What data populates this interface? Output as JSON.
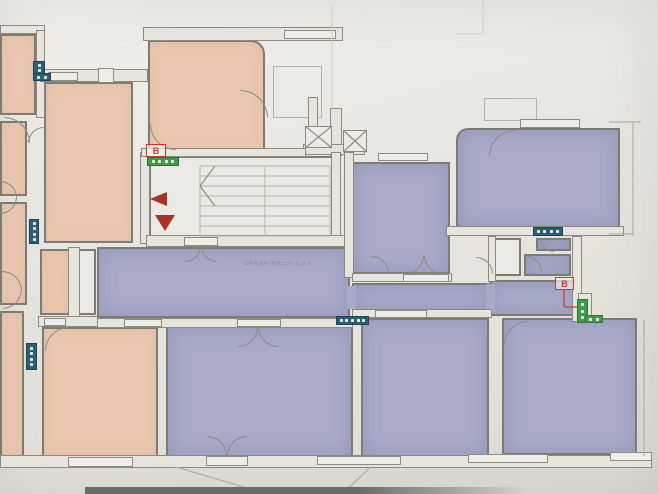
{
  "document": {
    "kind": "scanned-floor-plan-photo",
    "canvas": {
      "w": 658,
      "h": 494
    }
  },
  "corridor": {
    "label": "GRANATRVESF d o 6"
  },
  "palette": {
    "pink": "#eac8b0",
    "purple": "#a8aac8",
    "white_room": "#eae9e3",
    "wall_fill": "#e6e4dd",
    "wall_edge": "#8a8a81",
    "teal_marker": "#2b5f73",
    "green_marker": "#3f9c4a",
    "red_marker": "#c23b30",
    "paper": "#e8e6e1",
    "stair_line": "#b4b3ab",
    "faint_line": "#cfcdc6"
  },
  "rooms": [
    {
      "name": "room-top-left-partial",
      "fill": "pink",
      "x": 0,
      "y": 34,
      "w": 36,
      "h": 81
    },
    {
      "name": "room-left-2",
      "fill": "pink",
      "x": 0,
      "y": 121,
      "w": 27,
      "h": 75
    },
    {
      "name": "room-left-3",
      "fill": "pink",
      "x": 0,
      "y": 202,
      "w": 27,
      "h": 103
    },
    {
      "name": "room-left-4",
      "fill": "pink",
      "x": 0,
      "y": 311,
      "w": 24,
      "h": 147
    },
    {
      "name": "room-main-upper-pink",
      "fill": "pink",
      "x": 44,
      "y": 82,
      "w": 89,
      "h": 161
    },
    {
      "name": "room-left-lower-pink",
      "fill": "pink",
      "x": 40,
      "y": 249,
      "w": 30,
      "h": 66
    },
    {
      "name": "shaft-left",
      "fill": "white",
      "x": 78,
      "y": 249,
      "w": 18,
      "h": 66
    },
    {
      "name": "room-top-middle-pink",
      "fill": "pink",
      "x": 148,
      "y": 40,
      "w": 117,
      "h": 115,
      "rad": "0 14px 0 0"
    },
    {
      "name": "room-bottom-pink",
      "fill": "pink",
      "x": 42,
      "y": 327,
      "w": 116,
      "h": 130
    },
    {
      "name": "stairwell",
      "fill": "white",
      "x": 149,
      "y": 156,
      "w": 192,
      "h": 87
    },
    {
      "name": "corridor-main",
      "fill": "purple",
      "x": 97,
      "y": 247,
      "w": 253,
      "h": 71
    },
    {
      "name": "corridor-arm",
      "fill": "purple",
      "x": 352,
      "y": 283,
      "w": 140,
      "h": 28
    },
    {
      "name": "corridor-right-end",
      "fill": "purple",
      "x": 490,
      "y": 280,
      "w": 88,
      "h": 36
    },
    {
      "name": "room-middle-purple",
      "fill": "purple",
      "x": 352,
      "y": 162,
      "w": 98,
      "h": 112
    },
    {
      "name": "room-top-right-purple",
      "fill": "purple",
      "x": 456,
      "y": 128,
      "w": 164,
      "h": 100,
      "rad": "12px 0 0 0"
    },
    {
      "name": "bath-small-1",
      "fill": "purple",
      "x": 536,
      "y": 238,
      "w": 35,
      "h": 13
    },
    {
      "name": "bath-small-2",
      "fill": "purple",
      "x": 524,
      "y": 254,
      "w": 47,
      "h": 22
    },
    {
      "name": "bath-shaft",
      "fill": "white",
      "x": 492,
      "y": 238,
      "w": 29,
      "h": 38
    },
    {
      "name": "room-bottom-1-purple",
      "fill": "purple",
      "x": 166,
      "y": 326,
      "w": 187,
      "h": 131
    },
    {
      "name": "room-bottom-2-purple",
      "fill": "purple",
      "x": 361,
      "y": 318,
      "w": 128,
      "h": 139
    },
    {
      "name": "room-bottom-3-purple",
      "fill": "purple",
      "x": 502,
      "y": 318,
      "w": 135,
      "h": 137
    }
  ],
  "patches": [
    {
      "name": "corridor-join-1",
      "x": 347,
      "y": 286,
      "w": 9,
      "h": 23
    },
    {
      "name": "corridor-join-2",
      "x": 486,
      "y": 284,
      "w": 9,
      "h": 28
    }
  ],
  "walls": [
    {
      "name": "wall-top-left",
      "x": 0,
      "y": 25,
      "w": 45,
      "h": 9
    },
    {
      "name": "wall-topleft-right",
      "x": 36,
      "y": 30,
      "w": 9,
      "h": 88
    },
    {
      "name": "wall-upper-pink-top",
      "x": 40,
      "y": 69,
      "w": 108,
      "h": 13
    },
    {
      "name": "wall-topmiddle-top",
      "x": 143,
      "y": 27,
      "w": 200,
      "h": 14
    },
    {
      "name": "wall-shaft-vertical",
      "x": 330,
      "y": 108,
      "w": 12,
      "h": 48
    },
    {
      "name": "wall-stair-upper",
      "x": 308,
      "y": 97,
      "w": 10,
      "h": 33
    },
    {
      "name": "wall-under-hatch",
      "x": 303,
      "y": 144,
      "w": 62,
      "h": 11
    },
    {
      "name": "wall-stair-right",
      "x": 331,
      "y": 152,
      "w": 10,
      "h": 86
    },
    {
      "name": "wall-stair-left",
      "x": 140,
      "y": 152,
      "w": 10,
      "h": 92
    },
    {
      "name": "wall-topmiddle-bottom",
      "x": 141,
      "y": 148,
      "w": 165,
      "h": 9
    },
    {
      "name": "wall-stair-bottom",
      "x": 146,
      "y": 235,
      "w": 206,
      "h": 12
    },
    {
      "name": "wall-middle-left",
      "x": 344,
      "y": 152,
      "w": 10,
      "h": 126
    },
    {
      "name": "wall-corridor-bottom",
      "x": 95,
      "y": 318,
      "w": 258,
      "h": 10
    },
    {
      "name": "wall-pink-bottom-top",
      "x": 38,
      "y": 316,
      "w": 60,
      "h": 11
    },
    {
      "name": "wall-arm-bottom",
      "x": 352,
      "y": 309,
      "w": 140,
      "h": 9
    },
    {
      "name": "wall-middle-bottom",
      "x": 352,
      "y": 273,
      "w": 100,
      "h": 9
    },
    {
      "name": "wall-topright-bottom",
      "x": 446,
      "y": 226,
      "w": 178,
      "h": 10
    },
    {
      "name": "wall-bath-right",
      "x": 572,
      "y": 236,
      "w": 10,
      "h": 86
    },
    {
      "name": "wall-right-stub",
      "x": 578,
      "y": 293,
      "w": 14,
      "h": 28
    },
    {
      "name": "wall-bath-left",
      "x": 488,
      "y": 236,
      "w": 8,
      "h": 46
    },
    {
      "name": "wall-left-shaft",
      "x": 68,
      "y": 247,
      "w": 12,
      "h": 70
    },
    {
      "name": "wall-bottom-outer",
      "x": 0,
      "y": 455,
      "w": 652,
      "h": 13
    }
  ],
  "windows": [
    {
      "name": "window-upper-pink-1",
      "x": 48,
      "y": 72,
      "w": 30,
      "h": 9
    },
    {
      "name": "window-upper-pink-box",
      "x": 98,
      "y": 68,
      "w": 16,
      "h": 15
    },
    {
      "name": "window-topmiddle",
      "x": 284,
      "y": 30,
      "w": 52,
      "h": 9
    },
    {
      "name": "window-topright",
      "x": 520,
      "y": 119,
      "w": 60,
      "h": 9
    },
    {
      "name": "window-middle-top",
      "x": 378,
      "y": 153,
      "w": 50,
      "h": 8
    },
    {
      "name": "window-corridor-1",
      "x": 124,
      "y": 319,
      "w": 38,
      "h": 8
    },
    {
      "name": "door-gap-corridor-b1",
      "x": 237,
      "y": 319,
      "w": 44,
      "h": 8
    },
    {
      "name": "door-gap-pink-bottom",
      "x": 44,
      "y": 318,
      "w": 22,
      "h": 8
    },
    {
      "name": "window-arm-bottom",
      "x": 375,
      "y": 310,
      "w": 52,
      "h": 8
    },
    {
      "name": "door-gap-middle-room",
      "x": 403,
      "y": 274,
      "w": 46,
      "h": 8
    },
    {
      "name": "door-gap-stair",
      "x": 184,
      "y": 237,
      "w": 34,
      "h": 9
    },
    {
      "name": "window-bottom-pink",
      "x": 68,
      "y": 457,
      "w": 65,
      "h": 10
    },
    {
      "name": "door-threshold-balcony",
      "x": 206,
      "y": 456,
      "w": 42,
      "h": 10
    },
    {
      "name": "window-bottom-1",
      "x": 317,
      "y": 456,
      "w": 84,
      "h": 9
    },
    {
      "name": "window-bottom-2",
      "x": 468,
      "y": 454,
      "w": 80,
      "h": 9
    },
    {
      "name": "window-bottom-3",
      "x": 610,
      "y": 452,
      "w": 42,
      "h": 9
    }
  ],
  "outlines": [
    {
      "name": "balcony-top-middle",
      "x": 273,
      "y": 66,
      "w": 49,
      "h": 52
    },
    {
      "name": "balcony-top-right",
      "x": 484,
      "y": 98,
      "w": 53,
      "h": 23
    }
  ],
  "hatches": [
    {
      "name": "shaft-hatch-1",
      "x": 305,
      "y": 126,
      "w": 27,
      "h": 22
    },
    {
      "name": "shaft-hatch-2",
      "x": 343,
      "y": 130,
      "w": 24,
      "h": 22
    }
  ],
  "arcs": [
    {
      "name": "door-arc",
      "x": 4,
      "y": 117,
      "r": 26,
      "c": "tr"
    },
    {
      "name": "door-arc",
      "x": 2,
      "y": 271,
      "r": 20,
      "c": "tr"
    },
    {
      "name": "door-arc",
      "x": 2,
      "y": 289,
      "r": 20,
      "c": "br"
    },
    {
      "name": "door-arc",
      "x": 0,
      "y": 181,
      "r": 17,
      "c": "tr"
    },
    {
      "name": "door-arc",
      "x": 0,
      "y": 197,
      "r": 17,
      "c": "br"
    },
    {
      "name": "door-arc",
      "x": 45,
      "y": 327,
      "r": 24,
      "c": "tl"
    },
    {
      "name": "door-arc",
      "x": 240,
      "y": 90,
      "r": 28,
      "c": "tr"
    },
    {
      "name": "door-arc",
      "x": 150,
      "y": 124,
      "r": 26,
      "c": "bl"
    },
    {
      "name": "door-arc",
      "x": 185,
      "y": 246,
      "r": 16,
      "c": "br"
    },
    {
      "name": "door-arc",
      "x": 201,
      "y": 246,
      "r": 16,
      "c": "bl"
    },
    {
      "name": "door-arc",
      "x": 238,
      "y": 327,
      "r": 20,
      "c": "br"
    },
    {
      "name": "door-arc",
      "x": 258,
      "y": 327,
      "r": 20,
      "c": "bl"
    },
    {
      "name": "door-arc",
      "x": 207,
      "y": 436,
      "r": 20,
      "c": "tr"
    },
    {
      "name": "door-arc",
      "x": 227,
      "y": 436,
      "r": 20,
      "c": "tl"
    },
    {
      "name": "door-arc",
      "x": 404,
      "y": 255,
      "r": 20,
      "c": "br"
    },
    {
      "name": "door-arc",
      "x": 424,
      "y": 255,
      "r": 20,
      "c": "bl"
    },
    {
      "name": "door-arc",
      "x": 371,
      "y": 256,
      "r": 18,
      "c": "tr"
    },
    {
      "name": "door-arc",
      "x": 489,
      "y": 130,
      "r": 26,
      "c": "tl"
    },
    {
      "name": "door-arc",
      "x": 504,
      "y": 321,
      "r": 24,
      "c": "tl"
    },
    {
      "name": "door-arc",
      "x": 526,
      "y": 256,
      "r": 16,
      "c": "tr"
    },
    {
      "name": "door-arc",
      "x": 540,
      "y": 238,
      "r": 14,
      "c": "bl"
    },
    {
      "name": "door-arc",
      "x": 476,
      "y": 257,
      "r": 17,
      "c": "tr"
    },
    {
      "name": "door-arc",
      "x": 28,
      "y": 127,
      "r": 16,
      "c": "tl"
    }
  ],
  "markers": [
    {
      "name": "radiator-marker",
      "c": "teal",
      "x": 33,
      "y": 61,
      "w": 12,
      "h": 14,
      "o": "v",
      "dots": 2
    },
    {
      "name": "radiator-marker",
      "c": "teal",
      "x": 33,
      "y": 73,
      "w": 18,
      "h": 8,
      "o": "h",
      "dots": 2
    },
    {
      "name": "radiator-marker",
      "c": "teal",
      "x": 29,
      "y": 219,
      "w": 10,
      "h": 25,
      "o": "v",
      "dots": 4
    },
    {
      "name": "radiator-marker",
      "c": "teal",
      "x": 26,
      "y": 343,
      "w": 11,
      "h": 27,
      "o": "v",
      "dots": 4
    },
    {
      "name": "radiator-marker",
      "c": "teal",
      "x": 336,
      "y": 316,
      "w": 33,
      "h": 9,
      "o": "h",
      "dots": 5
    },
    {
      "name": "radiator-marker",
      "c": "teal",
      "x": 533,
      "y": 227,
      "w": 30,
      "h": 9,
      "o": "h",
      "dots": 4
    },
    {
      "name": "vent-marker",
      "c": "green",
      "x": 147,
      "y": 157,
      "w": 32,
      "h": 9,
      "o": "h",
      "dots": 4
    },
    {
      "name": "vent-marker",
      "c": "green",
      "x": 577,
      "y": 299,
      "w": 11,
      "h": 24,
      "o": "v",
      "dots": 3
    },
    {
      "name": "vent-marker",
      "c": "green",
      "x": 585,
      "y": 315,
      "w": 18,
      "h": 8,
      "o": "h",
      "dots": 2
    }
  ],
  "b_labels": [
    {
      "name": "b-label-stairwell",
      "text": "B",
      "x": 146,
      "y": 144,
      "w": 20,
      "h": 13
    },
    {
      "name": "b-label-right",
      "text": "B",
      "x": 555,
      "y": 277,
      "w": 19,
      "h": 13
    }
  ],
  "triangles": [
    {
      "name": "stair-arrow-left",
      "x": 150,
      "y": 192,
      "w": 17,
      "h": 14,
      "dir": "left"
    },
    {
      "name": "stair-arrow-down",
      "x": 155,
      "y": 215,
      "w": 20,
      "h": 16,
      "dir": "down"
    }
  ],
  "lines": [
    {
      "x1": 200,
      "y1": 166,
      "x2": 330,
      "y2": 166,
      "k": "stair"
    },
    {
      "x1": 200,
      "y1": 176,
      "x2": 330,
      "y2": 176,
      "k": "stair"
    },
    {
      "x1": 200,
      "y1": 186,
      "x2": 330,
      "y2": 186,
      "k": "stair"
    },
    {
      "x1": 200,
      "y1": 196,
      "x2": 330,
      "y2": 196,
      "k": "stair"
    },
    {
      "x1": 200,
      "y1": 206,
      "x2": 330,
      "y2": 206,
      "k": "stair"
    },
    {
      "x1": 200,
      "y1": 216,
      "x2": 330,
      "y2": 216,
      "k": "stair"
    },
    {
      "x1": 200,
      "y1": 226,
      "x2": 330,
      "y2": 226,
      "k": "stair"
    },
    {
      "x1": 200,
      "y1": 236,
      "x2": 330,
      "y2": 236,
      "k": "stair"
    },
    {
      "x1": 200,
      "y1": 166,
      "x2": 200,
      "y2": 236,
      "k": "stair"
    },
    {
      "x1": 265,
      "y1": 166,
      "x2": 265,
      "y2": 236,
      "k": "stair"
    },
    {
      "x1": 330,
      "y1": 166,
      "x2": 330,
      "y2": 236,
      "k": "stair"
    },
    {
      "x1": 215,
      "y1": 166,
      "x2": 200,
      "y2": 186,
      "k": "wall"
    },
    {
      "x1": 200,
      "y1": 186,
      "x2": 215,
      "y2": 206,
      "k": "wall"
    },
    {
      "x1": 305,
      "y1": 126,
      "x2": 332,
      "y2": 148,
      "k": "wall"
    },
    {
      "x1": 332,
      "y1": 126,
      "x2": 305,
      "y2": 148,
      "k": "wall"
    },
    {
      "x1": 343,
      "y1": 130,
      "x2": 367,
      "y2": 152,
      "k": "wall"
    },
    {
      "x1": 367,
      "y1": 130,
      "x2": 343,
      "y2": 152,
      "k": "wall"
    },
    {
      "x1": 564,
      "y1": 290,
      "x2": 564,
      "y2": 307,
      "k": "red"
    },
    {
      "x1": 564,
      "y1": 307,
      "x2": 577,
      "y2": 307,
      "k": "red"
    },
    {
      "x1": 176,
      "y1": 467,
      "x2": 261,
      "y2": 492,
      "k": "outer"
    },
    {
      "x1": 261,
      "y1": 492,
      "x2": 344,
      "y2": 492,
      "k": "outer"
    },
    {
      "x1": 344,
      "y1": 492,
      "x2": 371,
      "y2": 467,
      "k": "outer"
    },
    {
      "x1": 483,
      "y1": 0,
      "x2": 483,
      "y2": 34,
      "k": "faint"
    },
    {
      "x1": 455,
      "y1": 34,
      "x2": 483,
      "y2": 34,
      "k": "faint"
    },
    {
      "x1": 332,
      "y1": 4,
      "x2": 332,
      "y2": 108,
      "k": "faint"
    },
    {
      "x1": 609,
      "y1": 122,
      "x2": 641,
      "y2": 122,
      "k": "outer"
    },
    {
      "x1": 633,
      "y1": 122,
      "x2": 633,
      "y2": 236,
      "k": "outer"
    },
    {
      "x1": 609,
      "y1": 234,
      "x2": 633,
      "y2": 234,
      "k": "outer"
    },
    {
      "x1": 644,
      "y1": 320,
      "x2": 644,
      "y2": 456,
      "k": "outer"
    }
  ],
  "line_styles": {
    "stair": {
      "color": "#b4b3ab",
      "w": 1
    },
    "wall": {
      "color": "#8e8d85",
      "w": 1.2
    },
    "red": {
      "color": "#c13a2f",
      "w": 1.2
    },
    "faint": {
      "color": "#cfcdc6",
      "w": 1
    },
    "outer": {
      "color": "#b0afa7",
      "w": 1.2
    }
  },
  "photo_artifacts": {
    "desk_strip": {
      "x": 85,
      "y": 487,
      "w": 440,
      "h": 7
    }
  }
}
